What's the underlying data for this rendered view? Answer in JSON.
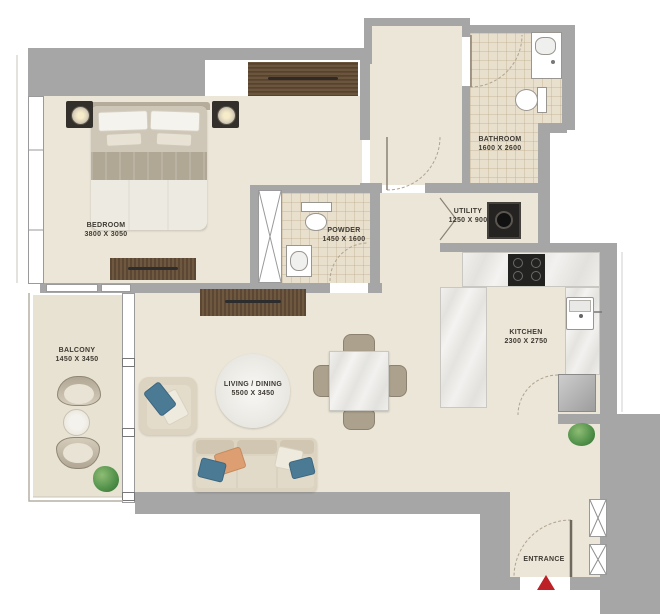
{
  "plan_title": "apartment-floor-plan",
  "rooms": {
    "bedroom": {
      "name": "BEDROOM",
      "dims": "3800 X 3050"
    },
    "bathroom": {
      "name": "BATHROOM",
      "dims": "1600 X 2600"
    },
    "powder": {
      "name": "POWDER",
      "dims": "1450 X 1600"
    },
    "utility": {
      "name": "UTILITY",
      "dims": "1250 X 900"
    },
    "kitchen": {
      "name": "KITCHEN",
      "dims": "2300 X 2750"
    },
    "living_dining": {
      "name": "LIVING / DINING",
      "dims": "5500 X 3450"
    },
    "balcony": {
      "name": "BALCONY",
      "dims": "1450 X 3450"
    },
    "entrance": {
      "name": "ENTRANCE"
    }
  },
  "colors": {
    "wall": "#a6a6a6",
    "floor": "#ece6d8",
    "wet_area_tile": "#e8dfcd",
    "wood": "#5e4833",
    "marble": "#efeeea",
    "sofa": "#dcd3c0",
    "pillow_blue": "#4b7a95",
    "pillow_orange": "#dd9f72",
    "plant_green": "#55944d",
    "entrance_arrow_red": "#bd2026",
    "label_text": "#3e3a33"
  }
}
